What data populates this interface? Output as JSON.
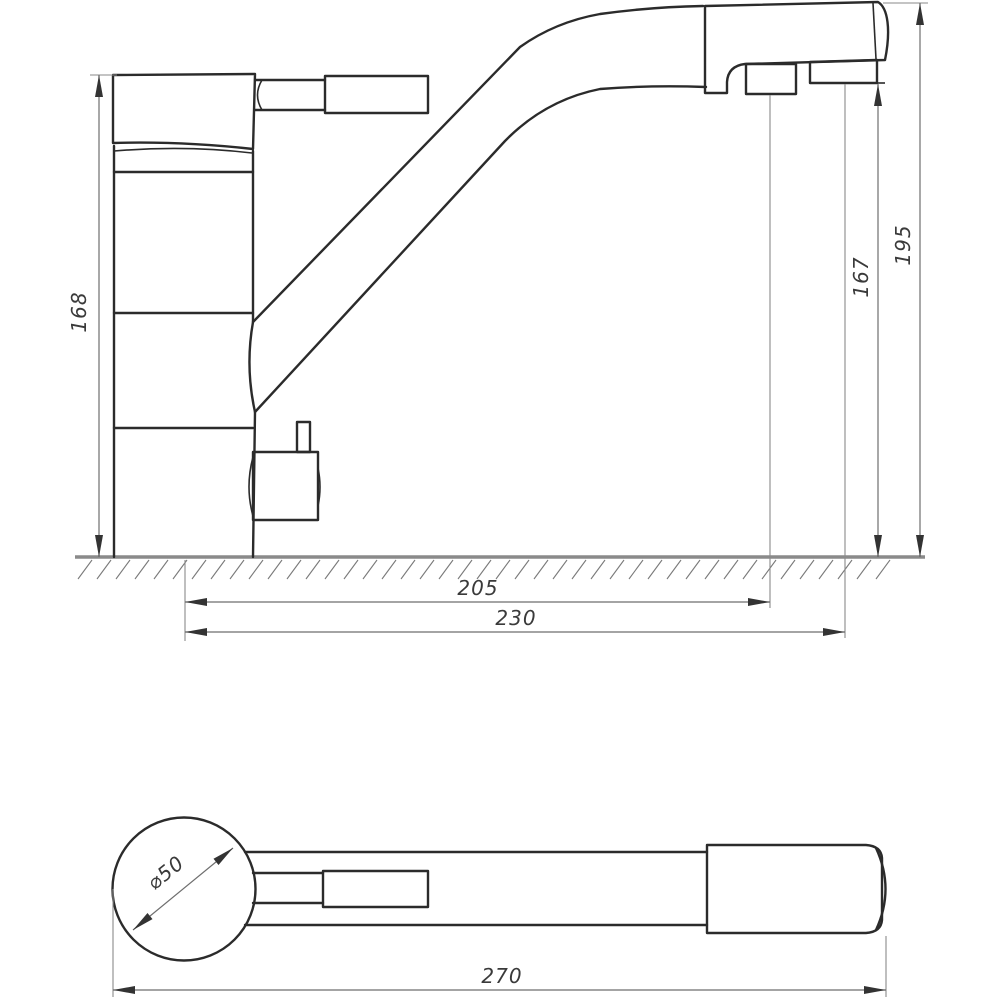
{
  "drawing": {
    "side_view": {
      "body_height": "168",
      "total_height": "195",
      "outlet_height": "167",
      "aerator_reach": "205",
      "outlet_reach": "230"
    },
    "top_view": {
      "base_diameter": "⌀50",
      "total_length": "270"
    }
  }
}
